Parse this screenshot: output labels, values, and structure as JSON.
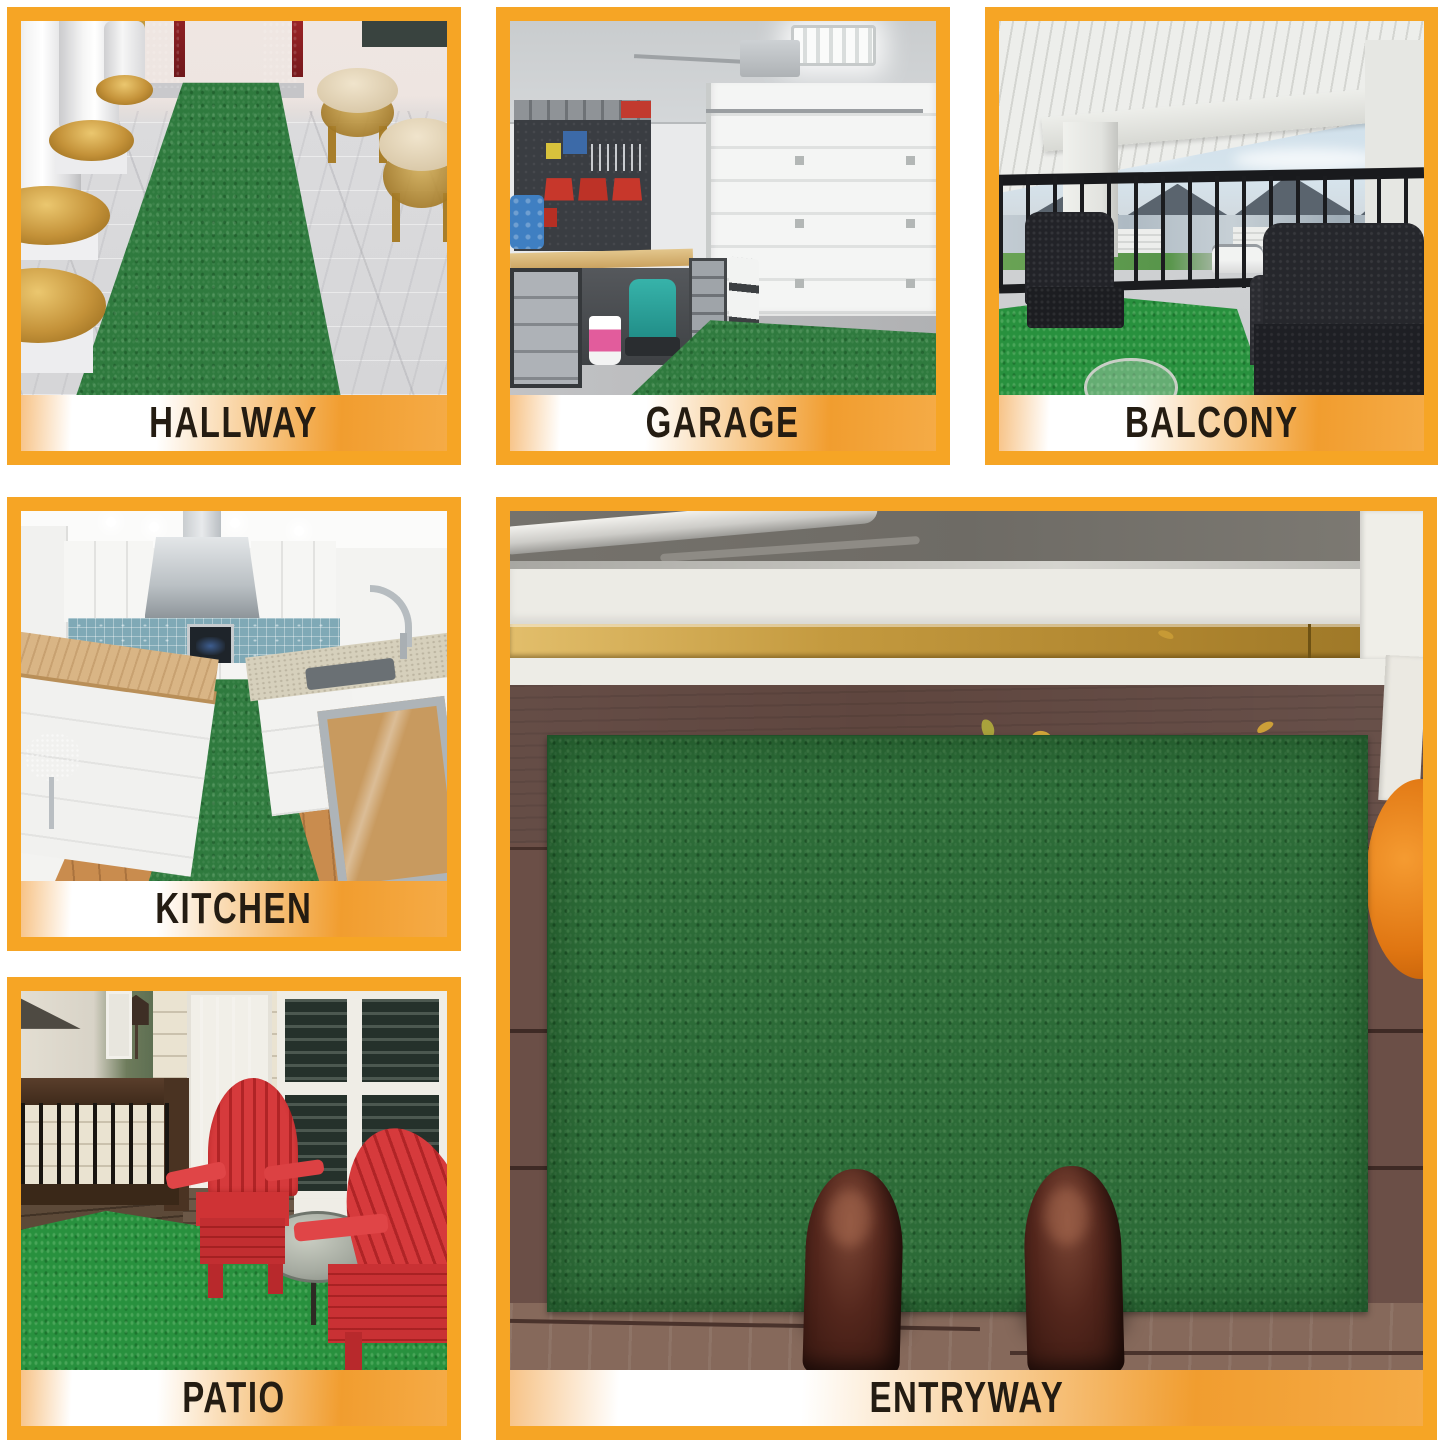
{
  "collage": {
    "panels": [
      {
        "id": "hallway",
        "label": "HALLWAY"
      },
      {
        "id": "garage",
        "label": "GARAGE"
      },
      {
        "id": "balcony",
        "label": "BALCONY"
      },
      {
        "id": "kitchen",
        "label": "KITCHEN"
      },
      {
        "id": "patio",
        "label": "PATIO"
      },
      {
        "id": "entryway",
        "label": "ENTRYWAY"
      }
    ],
    "colors": {
      "border_orange": "#F6A525",
      "label_text": "#241C12",
      "label_gradient_white": "#FFFFFF",
      "label_gradient_orange": "#F19D2F",
      "rug_green": "#2F7A3E",
      "turf_bright_green": "#28913E",
      "rug_dark_green": "#2C6B37",
      "background": "#FFFFFF"
    }
  }
}
